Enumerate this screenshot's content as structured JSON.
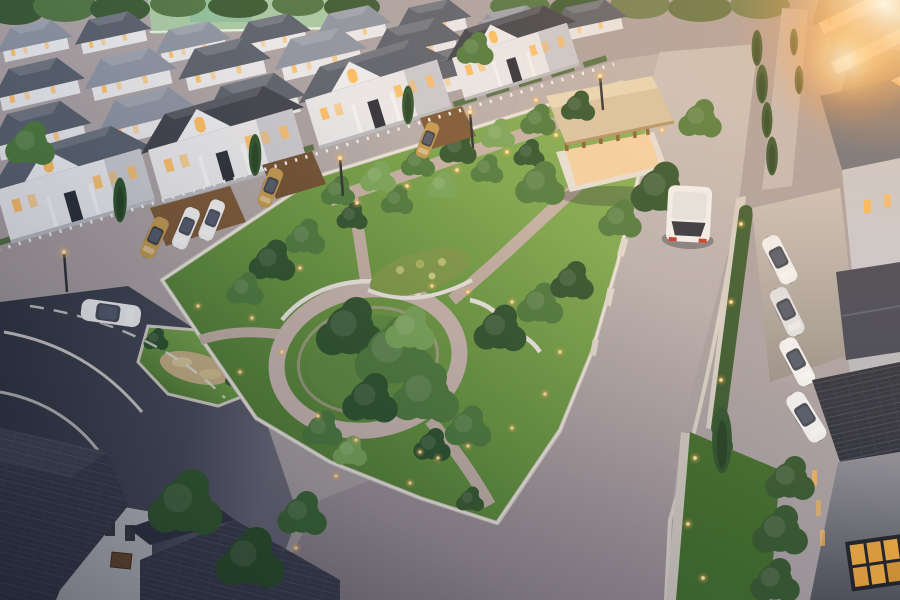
{
  "image": {
    "description": "Dusk aerial 3D render of a suburban housing estate: rows of grey-roofed white villas, a landscaped triangular central park with a circular paved plaza and timber pavilion, tree-lined streets with glowing lamps, a white sedan and a white minivan on the roads, parked cars in driveways, dark foreground rooftops and a warm sun glare in the top-right corner",
    "width": "900",
    "height": "600"
  },
  "palette": {
    "base": "#aba3a6",
    "field": "#a7c9a6",
    "field-court": "#8fbf9f",
    "treeline": "#3c5c38",
    "treeline-warm": "#6d8054",
    "roof": "#5a6270",
    "roof-dark": "#3f4450",
    "roof-light": "#8d95a5",
    "roof-warm": "#8a7e76",
    "wall": "#e9eaee",
    "wall-shade": "#c9cbd3",
    "dark-wall": "#8d8e96",
    "window-lit": "#ffb954",
    "street": "#b4acae",
    "road-hi": "#c8c4c2",
    "road-lo": "#8e858c",
    "asphalt": "#343a48",
    "lane": "#e9e7e2",
    "curb": "#d8d2ca",
    "path": "#c3b2a8",
    "plaza-ring": "#c9b8b2",
    "seat-wall": "#edeae5",
    "wood": "#8a6136",
    "wood-roof": "#d8c7a6",
    "wood-top": "#e7dabb",
    "drive": "#c6c0bb",
    "lawn-hi": "#8ab65c",
    "lawn": "#679742",
    "lawn-dark": "#44702f",
    "tree": "#4e7c40",
    "tree-dark": "#2f5530",
    "tree-light": "#79a75c",
    "hedge": "#3a5c33",
    "car-white": "#f2f3f5",
    "car-gold": "#c19a52",
    "lamp-core": "#ffe6ad",
    "sun": "#ffc57e"
  },
  "inventory": {
    "vehicles": {
      "moving_white_sedan": 1,
      "moving_white_minivan": 1,
      "parked_cars": 7,
      "carport_cars": 5
    },
    "park": {
      "circular_plaza": 1,
      "timber_pavilion": 1,
      "flower_bed": 1,
      "seating_walls": 2,
      "lit_bollards_and_lamps": 35
    },
    "housing": {
      "distant_roof_rows": 3,
      "left_villas": 4,
      "right_side_houses": 6,
      "foreground_roofs": 3
    },
    "roads": {
      "streets": 4,
      "markings": "white solid and dashed curves on dark asphalt"
    }
  }
}
